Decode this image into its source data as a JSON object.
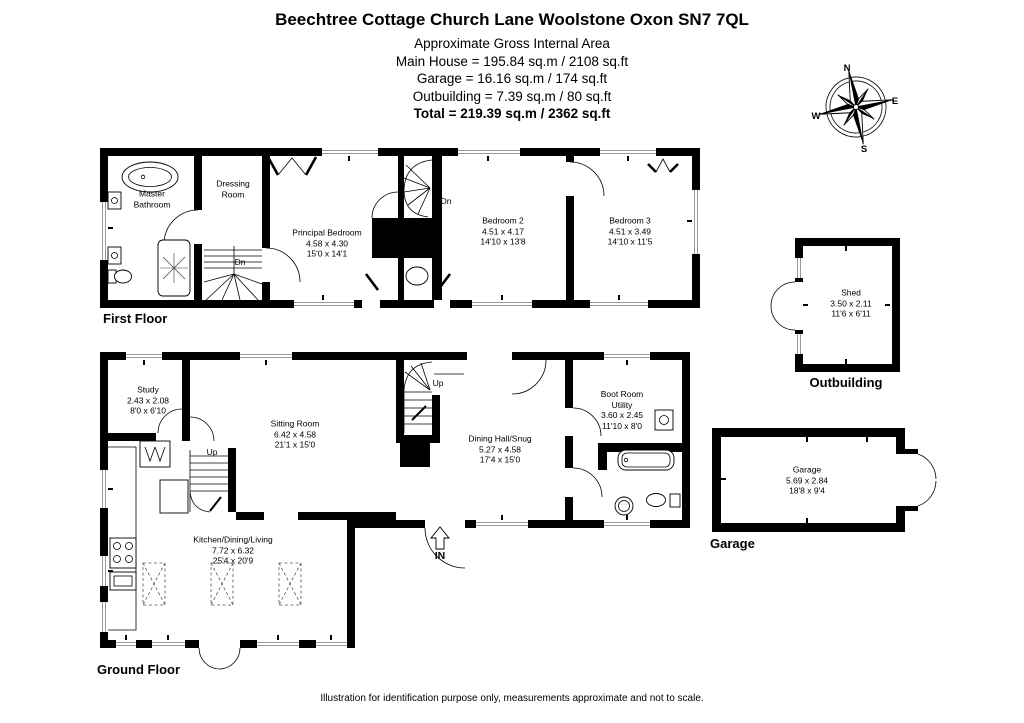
{
  "header": {
    "title": "Beechtree Cottage Church Lane Woolstone Oxon SN7 7QL",
    "subtitle": "Approximate Gross Internal Area",
    "main_house": "Main House = 195.84 sq.m / 2108 sq.ft",
    "garage": "Garage = 16.16 sq.m / 174 sq.ft",
    "outbuilding": "Outbuilding = 7.39 sq.m / 80 sq.ft",
    "total": "Total = 219.39 sq.m / 2362 sq.ft"
  },
  "first_floor": {
    "label": "First Floor",
    "stair_down_1": "Dn",
    "stair_down_2": "Dn",
    "rooms": {
      "master_bathroom": {
        "name": "Master Bathroom"
      },
      "dressing_room": {
        "name": "Dressing Room"
      },
      "principal_bedroom": {
        "name": "Principal Bedroom",
        "dims_m": "4.58 x 4.30",
        "dims_ft": "15'0 x 14'1"
      },
      "bedroom_2": {
        "name": "Bedroom 2",
        "dims_m": "4.51 x 4.17",
        "dims_ft": "14'10 x 13'8"
      },
      "bedroom_3": {
        "name": "Bedroom 3",
        "dims_m": "4.51 x 3.49",
        "dims_ft": "14'10 x 11'5"
      }
    }
  },
  "ground_floor": {
    "label": "Ground Floor",
    "stair_up_1": "Up",
    "stair_up_2": "Up",
    "entrance": "IN",
    "rooms": {
      "study": {
        "name": "Study",
        "dims_m": "2.43 x 2.08",
        "dims_ft": "8'0 x 6'10"
      },
      "sitting_room": {
        "name": "Sitting Room",
        "dims_m": "6.42 x 4.58",
        "dims_ft": "21'1 x 15'0"
      },
      "dining_hall": {
        "name": "Dining Hall/Snug",
        "dims_m": "5.27 x 4.58",
        "dims_ft": "17'4 x 15'0"
      },
      "boot_room": {
        "name": "Boot Room Utility",
        "dims_m": "3.60 x 2.45",
        "dims_ft": "11'10 x 8'0"
      },
      "kitchen": {
        "name": "Kitchen/Dining/Living",
        "dims_m": "7.72 x 6.32",
        "dims_ft": "25'4 x 20'9"
      }
    }
  },
  "outbuilding": {
    "label": "Outbuilding",
    "room": {
      "name": "Shed",
      "dims_m": "3.50 x 2.11",
      "dims_ft": "11'6 x 6'11"
    }
  },
  "garage": {
    "label": "Garage",
    "room": {
      "name": "Garage",
      "dims_m": "5.69 x 2.84",
      "dims_ft": "18'8 x 9'4"
    }
  },
  "compass": {
    "north": "N",
    "east": "E",
    "south": "S",
    "west": "W"
  },
  "footer": "Illustration for identification purpose only, measurements approximate and not to scale.",
  "colors": {
    "wall": "#000000",
    "background": "#ffffff",
    "glazing": "#999999"
  }
}
